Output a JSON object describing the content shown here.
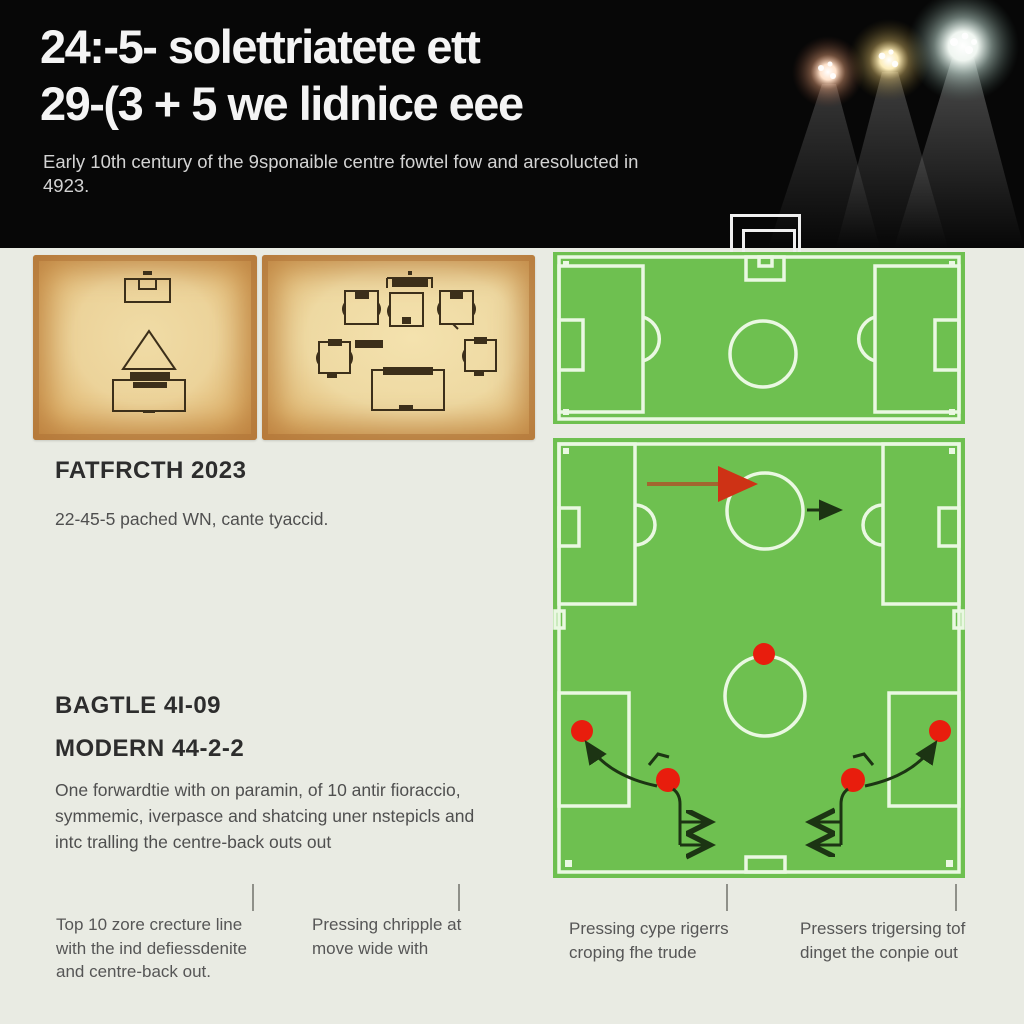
{
  "header": {
    "title_line1": "24:-5- solettriatete ett",
    "title_line2": "29-(3 + 5 we lidnice eee",
    "subtitle_line1": "Early 10th century of the 9sponaible centre fowtel fow and aresolucted in",
    "subtitle_line2": "4923."
  },
  "left_panel": {
    "history": {
      "heading": "FATFRCTH 2023",
      "body": "22-45-5 pached WN, cante tyaccid."
    },
    "battle_heading": "BAGTLE 4I-09",
    "modern_heading": "MODERN 44-2-2",
    "modern_paragraph": {
      "lines": [
        "One forwardtie with on paramin, of 10 antir fioraccio,",
        "symmemic, iverpasce and shatcing uner nstepicls and",
        "intc tralling the centre-back outs out"
      ]
    }
  },
  "captions": [
    {
      "lines": [
        "Top 10 zore crecture line",
        "with the ind defiessdenite",
        "and centre-back out."
      ]
    },
    {
      "lines": [
        "Pressing chripple at",
        "move wide with"
      ]
    },
    {
      "lines": [
        "Pressing cype rigerrs",
        "croping fhe trude"
      ]
    },
    {
      "lines": [
        "Pressers trigersing tof",
        "dinget the conpie out"
      ]
    }
  ],
  "icons": {
    "floodlights": [
      "floodlight-warm",
      "floodlight-gold",
      "floodlight-white"
    ],
    "pitch_markers": "red-player-dot",
    "arrows": [
      "pressing-run-arrow-red",
      "short-pass-arrow-dark",
      "curved-press-arrow",
      "drop-movement-arrow"
    ]
  },
  "colors": {
    "header-bg": "#070707",
    "page-bg": "#e9ebe3",
    "title-text": "#f4f4f4",
    "subtitle-text": "#d3d3d3",
    "heading-text": "#2d2d2d",
    "body-text": "#4f4f4f",
    "caption-text": "#565656",
    "divider": "#8f9089",
    "pitch-green": "#6ec050",
    "pitch-line": "#eaf8e2",
    "marker-red": "#e81d0d",
    "arrow-shaft": "#a2662f",
    "arrow-head": "#ce3215",
    "dark-stroke": "#1c3413",
    "ink": "#3c2f1a"
  }
}
